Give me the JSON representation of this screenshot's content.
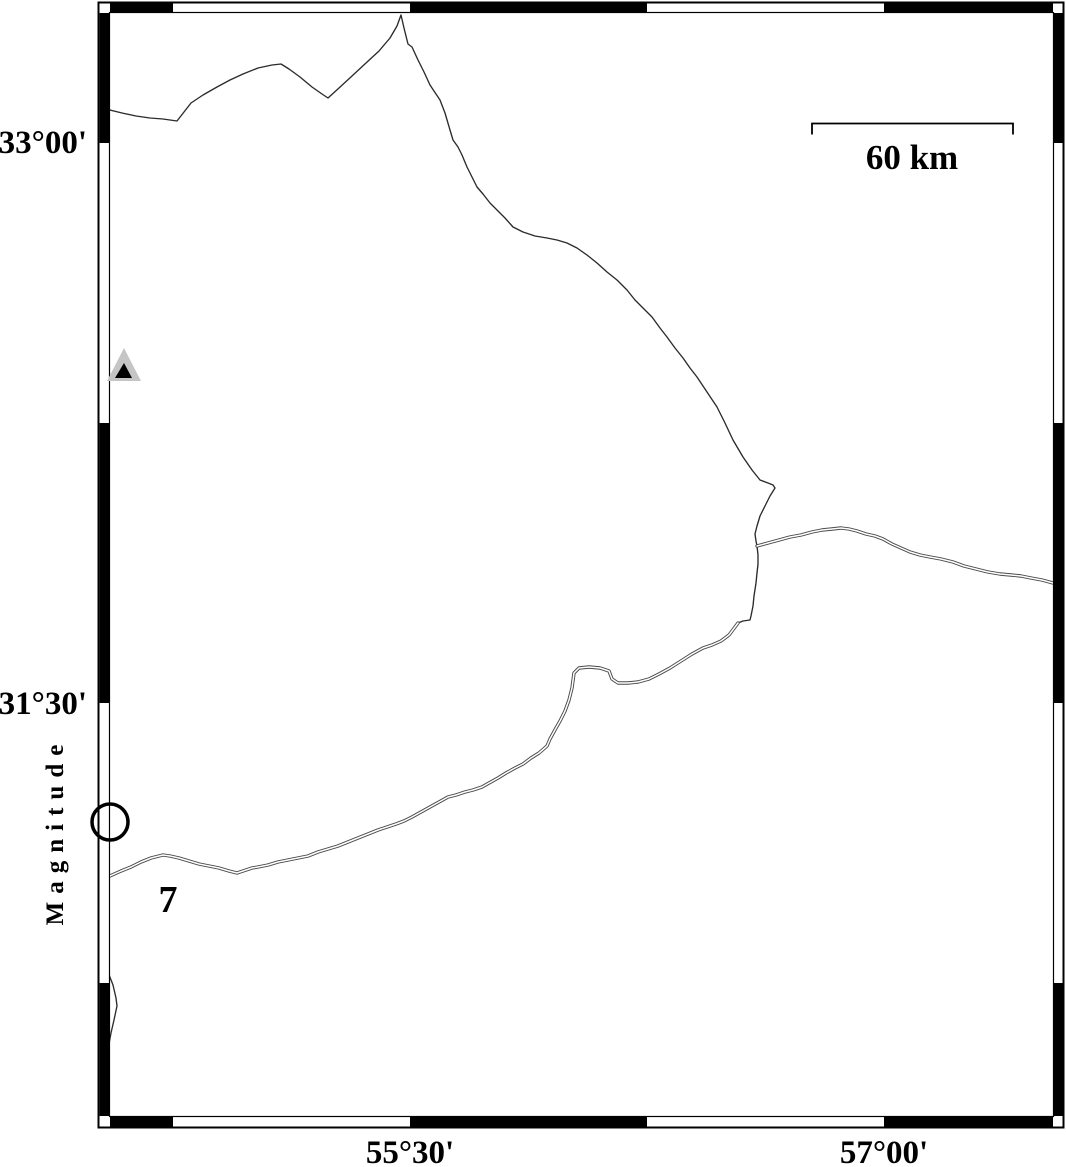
{
  "map": {
    "axis_labels": {
      "left": [
        {
          "text": "33°00'",
          "x": 87,
          "y": 153
        },
        {
          "text": "31°30'",
          "x": 87,
          "y": 714
        }
      ],
      "bottom": [
        {
          "text": "55°30'",
          "x": 410,
          "y": 1163
        },
        {
          "text": "57°00'",
          "x": 884,
          "y": 1163
        }
      ]
    },
    "scale_bar": {
      "label": "60 km",
      "x1": 812,
      "x2": 1013,
      "y": 123.5,
      "tick_drop": 11,
      "label_x": 912,
      "label_y": 169
    },
    "legend": {
      "title": "Magnitude",
      "value": "7",
      "circle": {
        "cx": 110,
        "cy": 822,
        "r": 18,
        "stroke_width": 3.5
      },
      "title_pos": {
        "x": 63,
        "y": 831
      },
      "value_pos": {
        "x": 168,
        "y": 912
      }
    },
    "station_marker": {
      "outer_points": "124,348 107,381 141,381",
      "inner_points": "124,363 115,378 132,378"
    }
  },
  "frame": {
    "outer": {
      "x": 98,
      "y": 2,
      "w": 966,
      "h": 1126
    },
    "inner": {
      "x": 109.5,
      "y": 12.5,
      "w": 944,
      "h": 1104
    },
    "h_black_segments": [
      [
        110,
        173
      ],
      [
        410,
        647
      ],
      [
        884,
        1053
      ]
    ],
    "v_black_segments": [
      [
        13,
        143
      ],
      [
        423,
        703
      ],
      [
        983,
        1116
      ]
    ]
  },
  "features": {
    "lines": [
      {
        "name": "boundary-line-north",
        "style": "single",
        "points": [
          [
            110,
            110
          ],
          [
            122,
            113
          ],
          [
            136,
            116
          ],
          [
            150,
            118
          ],
          [
            163,
            119
          ],
          [
            177,
            121
          ],
          [
            184,
            112
          ],
          [
            191,
            103
          ],
          [
            203,
            95
          ],
          [
            217,
            87
          ],
          [
            230,
            80
          ],
          [
            243,
            74
          ],
          [
            258,
            68
          ],
          [
            272,
            65
          ],
          [
            281,
            64
          ],
          [
            289,
            69
          ],
          [
            300,
            77
          ],
          [
            312,
            87
          ],
          [
            322,
            94
          ],
          [
            328,
            98
          ],
          [
            339,
            88
          ],
          [
            352,
            76
          ],
          [
            366,
            63
          ],
          [
            379,
            51
          ],
          [
            390,
            38
          ],
          [
            397,
            26
          ],
          [
            401,
            15
          ],
          [
            404,
            28
          ],
          [
            408,
            44
          ],
          [
            412,
            47
          ],
          [
            418,
            60
          ],
          [
            424,
            72
          ],
          [
            430,
            85
          ],
          [
            440,
            100
          ],
          [
            445,
            113
          ],
          [
            450,
            130
          ],
          [
            453,
            140
          ],
          [
            458,
            147
          ],
          [
            462,
            155
          ],
          [
            467,
            167
          ],
          [
            472,
            177
          ],
          [
            477,
            187
          ],
          [
            483,
            194
          ],
          [
            490,
            203
          ],
          [
            497,
            210
          ],
          [
            505,
            218
          ],
          [
            513,
            227
          ],
          [
            523,
            232
          ],
          [
            535,
            236
          ],
          [
            547,
            238
          ],
          [
            557,
            240
          ],
          [
            567,
            243
          ],
          [
            577,
            248
          ],
          [
            587,
            255
          ],
          [
            597,
            263
          ],
          [
            607,
            272
          ],
          [
            617,
            280
          ],
          [
            627,
            290
          ],
          [
            635,
            300
          ],
          [
            643,
            308
          ],
          [
            652,
            317
          ],
          [
            660,
            328
          ],
          [
            667,
            337
          ],
          [
            675,
            348
          ],
          [
            683,
            358
          ],
          [
            690,
            368
          ],
          [
            697,
            377
          ],
          [
            707,
            392
          ],
          [
            717,
            407
          ],
          [
            725,
            423
          ],
          [
            733,
            440
          ],
          [
            743,
            457
          ],
          [
            752,
            470
          ],
          [
            760,
            480
          ],
          [
            768,
            483
          ],
          [
            773,
            485
          ],
          [
            775,
            488
          ],
          [
            770,
            496
          ],
          [
            765,
            506
          ],
          [
            760,
            516
          ],
          [
            757,
            526
          ],
          [
            755,
            534
          ],
          [
            756,
            541
          ],
          [
            757,
            546
          ],
          [
            758,
            555
          ],
          [
            758,
            564
          ],
          [
            757,
            573
          ],
          [
            756,
            583
          ],
          [
            754,
            596
          ],
          [
            753,
            606
          ],
          [
            751,
            616
          ],
          [
            750,
            620
          ],
          [
            743,
            621
          ],
          [
            738,
            623
          ]
        ]
      },
      {
        "name": "boundary-line-east",
        "style": "double",
        "points": [
          [
            757,
            546
          ],
          [
            768,
            543
          ],
          [
            779,
            540
          ],
          [
            790,
            537
          ],
          [
            801,
            535
          ],
          [
            812,
            532
          ],
          [
            822,
            530
          ],
          [
            832,
            529
          ],
          [
            841,
            528
          ],
          [
            849,
            529
          ],
          [
            857,
            531
          ],
          [
            866,
            534
          ],
          [
            875,
            536
          ],
          [
            883,
            539
          ],
          [
            892,
            544
          ],
          [
            901,
            548
          ],
          [
            910,
            552
          ],
          [
            920,
            555
          ],
          [
            930,
            557
          ],
          [
            941,
            559
          ],
          [
            953,
            562
          ],
          [
            964,
            566
          ],
          [
            976,
            569
          ],
          [
            988,
            572
          ],
          [
            1000,
            574
          ],
          [
            1011,
            575
          ],
          [
            1021,
            576
          ],
          [
            1031,
            578
          ],
          [
            1042,
            580
          ],
          [
            1053,
            583
          ]
        ]
      },
      {
        "name": "boundary-line-southwest",
        "style": "double",
        "points": [
          [
            738,
            623
          ],
          [
            729,
            635
          ],
          [
            721,
            641
          ],
          [
            712,
            645
          ],
          [
            703,
            648
          ],
          [
            692,
            654
          ],
          [
            681,
            661
          ],
          [
            670,
            668
          ],
          [
            659,
            674
          ],
          [
            649,
            679
          ],
          [
            638,
            682
          ],
          [
            628,
            683
          ],
          [
            618,
            683
          ],
          [
            612,
            679
          ],
          [
            609,
            671
          ],
          [
            600,
            668
          ],
          [
            589,
            667
          ],
          [
            579,
            668
          ],
          [
            574,
            673
          ],
          [
            572,
            688
          ],
          [
            569,
            700
          ],
          [
            565,
            711
          ],
          [
            560,
            721
          ],
          [
            556,
            728
          ],
          [
            550,
            739
          ],
          [
            547,
            746
          ],
          [
            539,
            753
          ],
          [
            531,
            758
          ],
          [
            523,
            764
          ],
          [
            515,
            768
          ],
          [
            506,
            773
          ],
          [
            498,
            778
          ],
          [
            489,
            783
          ],
          [
            482,
            787
          ],
          [
            473,
            790
          ],
          [
            465,
            792
          ],
          [
            456,
            795
          ],
          [
            448,
            797
          ],
          [
            439,
            802
          ],
          [
            430,
            807
          ],
          [
            421,
            812
          ],
          [
            412,
            817
          ],
          [
            404,
            821
          ],
          [
            396,
            824
          ],
          [
            387,
            827
          ],
          [
            378,
            830
          ],
          [
            368,
            834
          ],
          [
            358,
            838
          ],
          [
            348,
            842
          ],
          [
            338,
            846
          ],
          [
            328,
            849
          ],
          [
            318,
            852
          ],
          [
            308,
            856
          ],
          [
            298,
            858
          ],
          [
            288,
            860
          ],
          [
            278,
            862
          ],
          [
            268,
            865
          ],
          [
            258,
            867
          ],
          [
            252,
            868
          ],
          [
            243,
            871
          ],
          [
            237,
            873
          ],
          [
            229,
            871
          ],
          [
            219,
            868
          ],
          [
            209,
            866
          ],
          [
            199,
            864
          ],
          [
            189,
            861
          ],
          [
            179,
            858
          ],
          [
            170,
            856
          ],
          [
            163,
            855
          ],
          [
            151,
            858
          ],
          [
            141,
            862
          ],
          [
            131,
            867
          ],
          [
            121,
            871
          ],
          [
            110,
            876
          ]
        ]
      },
      {
        "name": "boundary-line-west-small",
        "style": "single",
        "points": [
          [
            103,
            928
          ],
          [
            105,
            947
          ],
          [
            108,
            972
          ],
          [
            113,
            985
          ],
          [
            116,
            998
          ],
          [
            117,
            1006
          ],
          [
            114,
            1020
          ],
          [
            111,
            1033
          ],
          [
            109,
            1044
          ]
        ]
      }
    ]
  },
  "colors": {
    "ink": "#000000",
    "single_line": "#2b2b2b",
    "double_line": "#4a4a4a",
    "double_line_core": "#ffffff",
    "marker_gray": "#c5c5c5",
    "marker_inner": "#000000",
    "background": "#ffffff"
  }
}
